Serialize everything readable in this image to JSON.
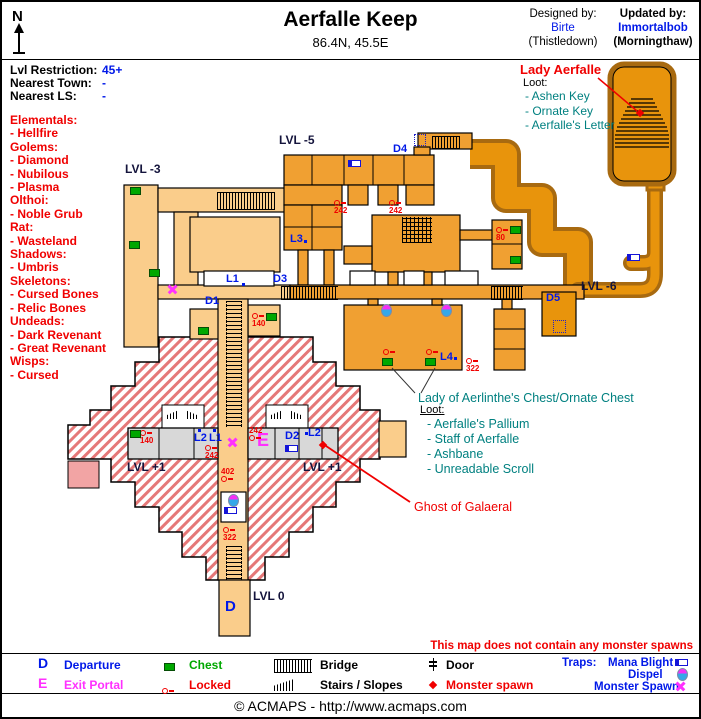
{
  "header": {
    "compass": "N",
    "title": "Aerfalle Keep",
    "coordinates": "86.4N, 45.5E",
    "designed_label": "Designed by:",
    "designed_name": "Birte",
    "designed_server": "(Thistledown)",
    "updated_label": "Updated by:",
    "updated_name": "Immortalbob",
    "updated_server": "(Morningthaw)"
  },
  "info": {
    "lvl_restriction_label": "Lvl Restriction:",
    "lvl_restriction": "45+",
    "nearest_town_label": "Nearest Town:",
    "nearest_town": "-",
    "nearest_ls_label": "Nearest LS:",
    "nearest_ls": "-"
  },
  "creatures": "Elementals:\n- Hellfire\nGolems:\n- Diamond\n- Nubilous\n- Plasma\nOlthoi:\n- Noble Grub\nRat:\n- Wasteland\nShadows:\n- Umbris\nSkeletons:\n- Cursed Bones\n- Relic Bones\nUndeads:\n- Dark Revenant\n- Great Revenant\nWisps:\n- Cursed",
  "map": {
    "levels": {
      "lvl3": "LVL -3",
      "lvl5": "LVL -5",
      "lvl6": "LVL -6",
      "lvl1_left": "LVL +1",
      "lvl1_right": "LVL +1",
      "lvl0": "LVL 0"
    },
    "labels": {
      "l1_top": "L1",
      "l3": "L3",
      "l4": "L4",
      "hall_l2": "L2",
      "hall_l1": "L1",
      "hall_l2_right": "L2"
    },
    "portals": {
      "d1": "D1",
      "d2": "D2",
      "d3": "D3",
      "d4": "D4",
      "d5": "D5",
      "departure": "D",
      "exit": "E"
    },
    "locks": {
      "top_242_a": "242",
      "top_242_b": "242",
      "room_140": "140",
      "chests_80": "80",
      "hall_140": "140",
      "hall_242_top": "242",
      "hall_242_bottom": "242",
      "shaft_402": "402",
      "shaft_322": "322",
      "east_322": "322"
    }
  },
  "annotations": {
    "lady_title": "Lady Aerfalle",
    "lady_loot_label": "Loot:",
    "lady_loot": "- Ashen Key\n- Ornate Key\n- Aerfalle's Letter",
    "chest_title": "Lady of Aerlinthe's Chest/Ornate Chest",
    "chest_loot_label": "Loot:",
    "chest_loot": "- Aerfalle's Pallium\n- Staff of Aerfalle\n- Ashbane\n- Unreadable Scroll",
    "ghost": "Ghost of Galaeral",
    "no_spawns": "This map does not contain any monster spawns"
  },
  "legend": {
    "departure_key": "D",
    "departure": "Departure",
    "exit_key": "E",
    "exit": "Exit Portal",
    "chest": "Chest",
    "locked": "Locked",
    "bridge": "Bridge",
    "stairs": "Stairs / Slopes",
    "door": "Door",
    "monster_spawn": "Monster spawn",
    "traps_label": "Traps:",
    "mana_blight": "Mana Blight",
    "dispel": "Dispel",
    "monster_spawn_trap": "Monster Spawn"
  },
  "footer": {
    "copyright": "© ACMAPS - http://www.acmaps.com"
  },
  "colors": {
    "tan": "#FACD8B",
    "orange": "#F0A032",
    "deep_orange": "#E8940C",
    "brown": "#A86A10",
    "hatch_red": "#E57878",
    "gray_hall": "#D8D8D8",
    "pink": "#F2A4A4",
    "blue": "#0018E8",
    "magenta": "#FF30FF",
    "red": "#F00000",
    "teal": "#008080",
    "green": "#00A800"
  }
}
